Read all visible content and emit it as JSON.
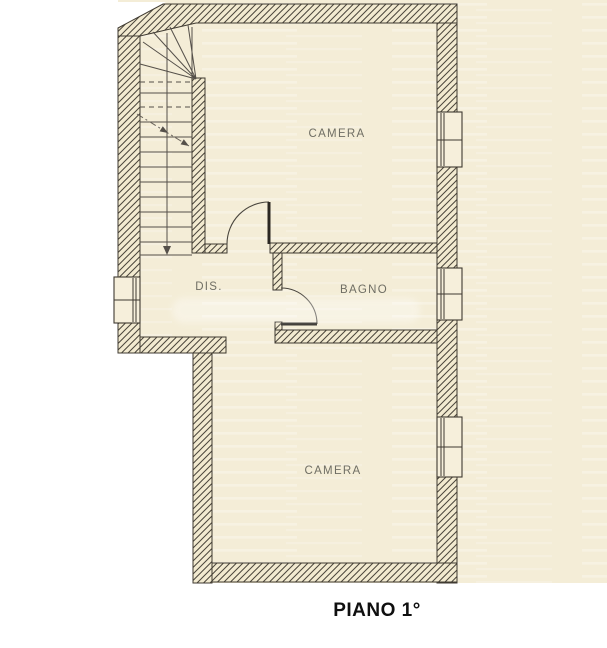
{
  "title": "PIANO 1°",
  "floor_plan": {
    "floor_label": "PIANO 1°",
    "rooms": [
      {
        "id": "camera-upper",
        "label": "CAMERA"
      },
      {
        "id": "dis",
        "label": "DIS."
      },
      {
        "id": "bagno",
        "label": "BAGNO"
      },
      {
        "id": "camera-lower",
        "label": "CAMERA"
      }
    ],
    "doors": [
      {
        "id": "door-camera-upper",
        "connects": "DIS. / CAMERA (upper)",
        "swing": "quarter-arc"
      },
      {
        "id": "door-bagno",
        "connects": "DIS. / BAGNO",
        "swing": "quarter-arc"
      }
    ],
    "windows": [
      {
        "id": "window-camera-upper",
        "room": "CAMERA (upper)",
        "wall": "right"
      },
      {
        "id": "window-bagno",
        "room": "BAGNO",
        "wall": "right"
      },
      {
        "id": "window-camera-lower",
        "room": "CAMERA (lower)",
        "wall": "right"
      },
      {
        "id": "window-dis",
        "room": "DIS.",
        "wall": "left"
      }
    ],
    "staircase": {
      "id": "staircase",
      "type": "winder stair, top-left, arrow down"
    },
    "colors": {
      "paper": "#ffffff",
      "plan_background": "#f4edd7",
      "wall_hatch": "#4a453b",
      "room_label": "#6f6e64",
      "floor_label": "#0f0f0f"
    }
  }
}
